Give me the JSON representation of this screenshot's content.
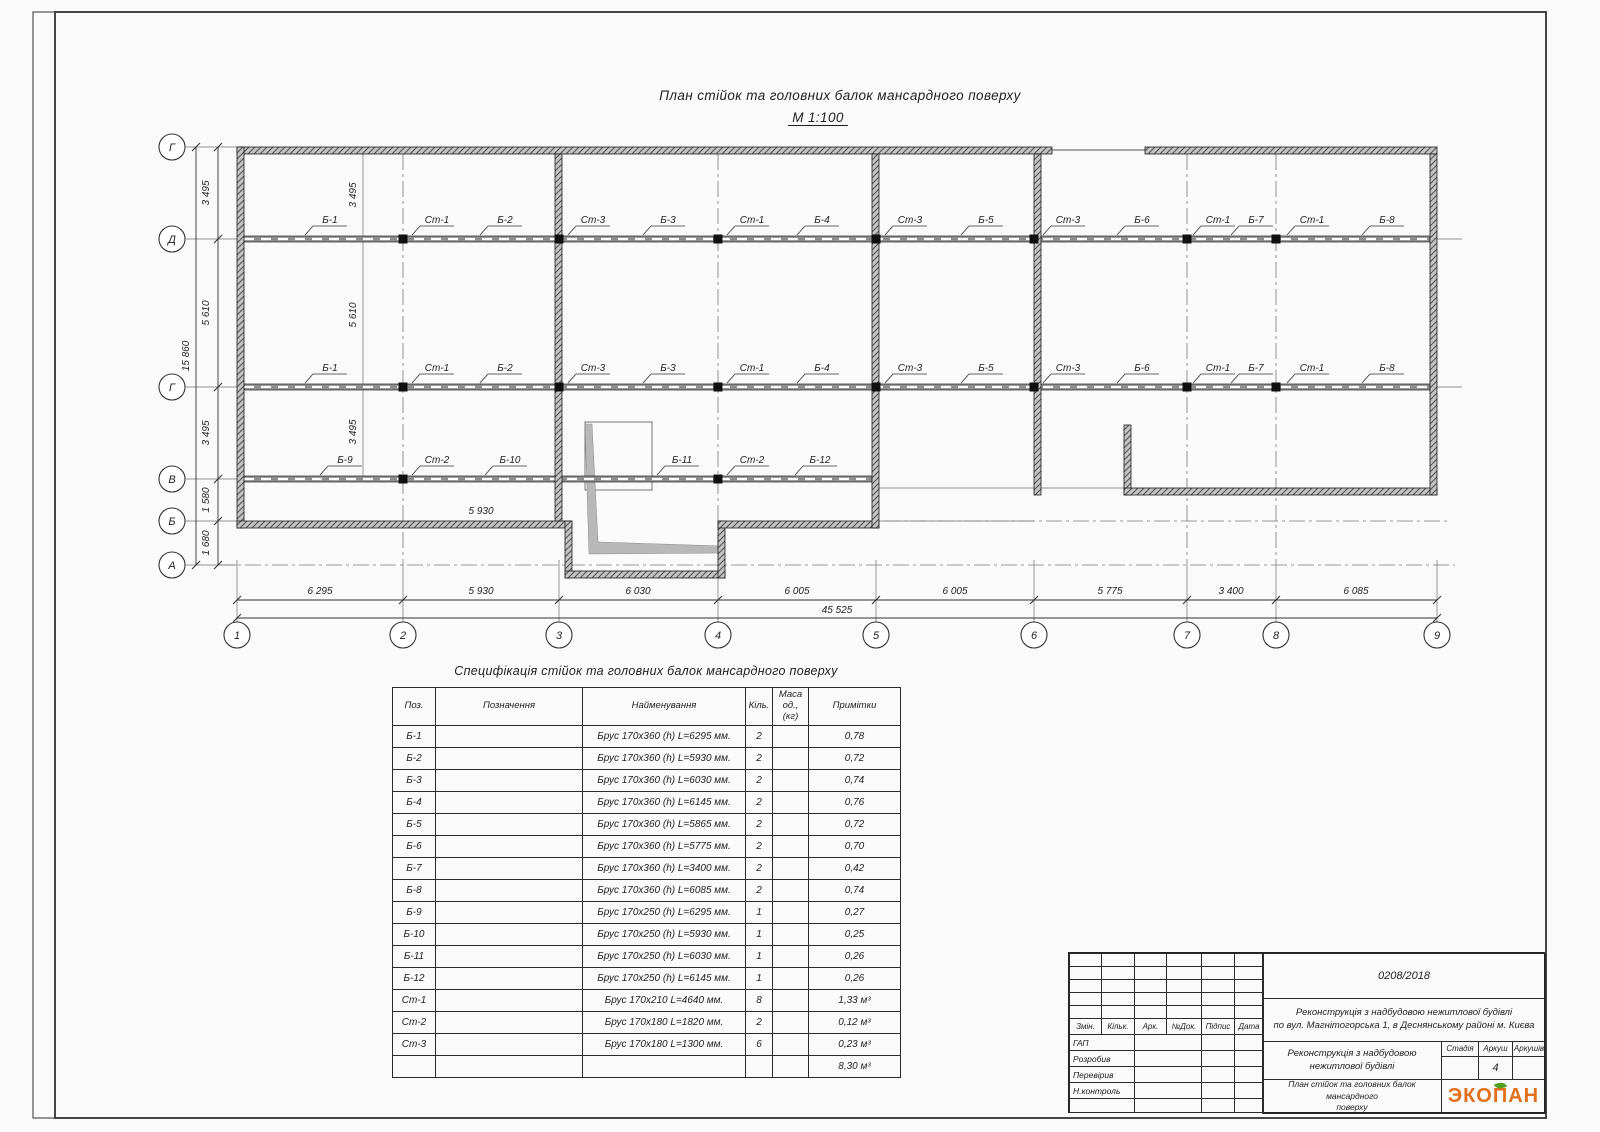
{
  "title": {
    "main": "План стійок та головних балок мансардного поверху",
    "scale": "М 1:100"
  },
  "plan": {
    "axes_rows": [
      "Г",
      "Д",
      "Г",
      "В",
      "Б",
      "А"
    ],
    "axes_cols": [
      "1",
      "2",
      "3",
      "4",
      "5",
      "6",
      "7",
      "8",
      "9"
    ],
    "dims_left": [
      "3 495",
      "5 610",
      "3 495",
      "1 580",
      "1 680"
    ],
    "dim_left_total": "15 860",
    "dims_inner": [
      "3 495",
      "5 610",
      "3 495"
    ],
    "dims_bottom": [
      "6 295",
      "5 930",
      "6 030",
      "6 005",
      "6 005",
      "5 775",
      "3 400",
      "6 085"
    ],
    "dim_bottom_total": "45 525",
    "dim_b_wall": "5 930",
    "row_d": [
      "Б-1",
      "Ст-1",
      "Б-2",
      "Ст-3",
      "Б-3",
      "Ст-1",
      "Б-4",
      "Ст-3",
      "Б-5",
      "Ст-3",
      "Б-6",
      "Ст-1",
      "Б-7",
      "Ст-1",
      "Б-8"
    ],
    "row_g": [
      "Б-1",
      "Ст-1",
      "Б-2",
      "Ст-3",
      "Б-3",
      "Ст-1",
      "Б-4",
      "Ст-3",
      "Б-5",
      "Ст-3",
      "Б-6",
      "Ст-1",
      "Б-7",
      "Ст-1",
      "Б-8"
    ],
    "row_v": [
      "Б-9",
      "Ст-2",
      "Б-10",
      "Б-11",
      "Ст-2",
      "Б-12"
    ]
  },
  "spec": {
    "title": "Специфікація стійок та головних балок мансардного поверху",
    "headers": [
      "Поз.",
      "Позначення",
      "Найменування",
      "Кіль.",
      "Маса од., (кг)",
      "Примітки"
    ],
    "rows": [
      [
        "Б-1",
        "",
        "Брус 170х360 (h)  L=6295 мм.",
        "2",
        "",
        "0,78"
      ],
      [
        "Б-2",
        "",
        "Брус 170х360 (h)  L=5930 мм.",
        "2",
        "",
        "0,72"
      ],
      [
        "Б-3",
        "",
        "Брус 170х360 (h)  L=6030 мм.",
        "2",
        "",
        "0,74"
      ],
      [
        "Б-4",
        "",
        "Брус 170х360 (h)  L=6145 мм.",
        "2",
        "",
        "0,76"
      ],
      [
        "Б-5",
        "",
        "Брус 170х360 (h)  L=5865 мм.",
        "2",
        "",
        "0,72"
      ],
      [
        "Б-6",
        "",
        "Брус 170х360 (h)  L=5775 мм.",
        "2",
        "",
        "0,70"
      ],
      [
        "Б-7",
        "",
        "Брус 170х360 (h)  L=3400 мм.",
        "2",
        "",
        "0,42"
      ],
      [
        "Б-8",
        "",
        "Брус 170х360 (h)  L=6085 мм.",
        "2",
        "",
        "0,74"
      ],
      [
        "Б-9",
        "",
        "Брус 170х250 (h)  L=6295 мм.",
        "1",
        "",
        "0,27"
      ],
      [
        "Б-10",
        "",
        "Брус 170х250 (h)  L=5930 мм.",
        "1",
        "",
        "0,25"
      ],
      [
        "Б-11",
        "",
        "Брус 170х250 (h)  L=6030 мм.",
        "1",
        "",
        "0,26"
      ],
      [
        "Б-12",
        "",
        "Брус 170х250 (h)  L=6145 мм.",
        "1",
        "",
        "0,26"
      ],
      [
        "Ст-1",
        "",
        "Брус 170х210  L=4640 мм.",
        "8",
        "",
        "1,33 м³"
      ],
      [
        "Ст-2",
        "",
        "Брус 170х180  L=1820 мм.",
        "2",
        "",
        "0,12 м³"
      ],
      [
        "Ст-3",
        "",
        "Брус 170х180  L=1300 мм.",
        "6",
        "",
        "0,23 м³"
      ],
      [
        "",
        "",
        "",
        "",
        "",
        "8,30 м³"
      ]
    ]
  },
  "titleblock": {
    "doc_number": "0208/2018",
    "project_line1": "Реконструкція з надбудовою нежитлової будівлі",
    "project_line2": "по вул. Магнітогорська 1, в Деснянському районі м. Києва",
    "object_line1": "Реконструкція з надбудовою",
    "object_line2": "нежитлової будівлі",
    "sheet_line1": "План стійок та головних балок мансардного",
    "sheet_line2": "поверху",
    "cols": [
      "Змін.",
      "Кільк.",
      "Арк.",
      "№Док.",
      "Підпис",
      "Дата"
    ],
    "roles": [
      "ГАП",
      "Розробив",
      "Перевірив",
      "Н.контроль"
    ],
    "stage_headers": [
      "Стадія",
      "Аркуш",
      "Аркушів"
    ],
    "sheet_number": "4",
    "logo": "ЭКОПАН",
    "logo_color": "#e2701a",
    "leaf_color": "#55a021"
  }
}
